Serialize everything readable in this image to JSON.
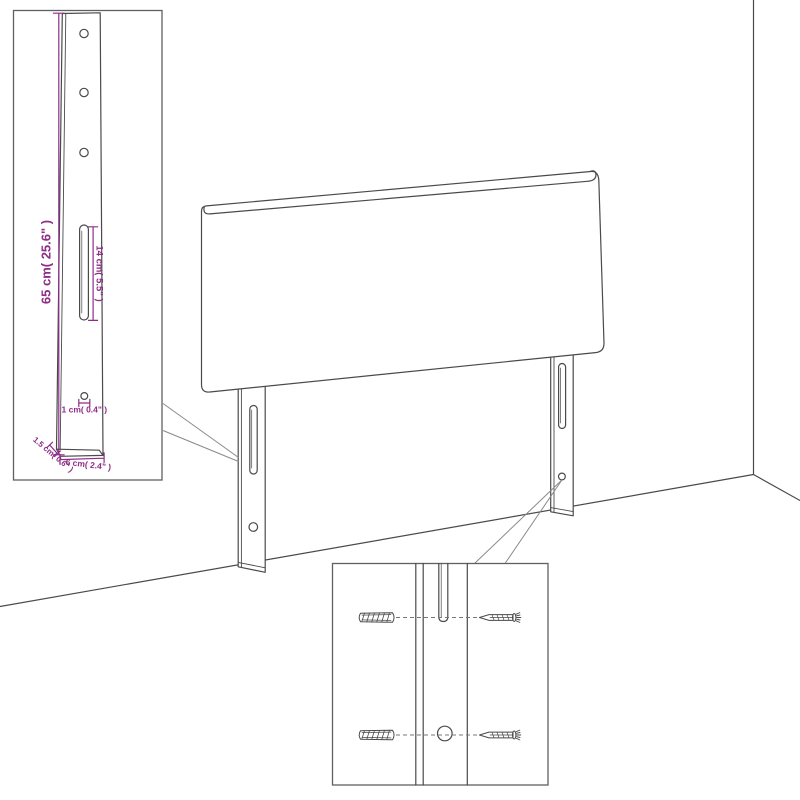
{
  "title": "headboard-assembly-diagram",
  "colors": {
    "background": "#ffffff",
    "line": "#4a4a4a",
    "dimension": "#8E2C88",
    "leader": "#8a8a8a"
  },
  "inset_leg_detail": {
    "height_label": "65 cm( 25.6\" )",
    "slot_height_label": "14 cm( 5.5\" )",
    "hole_diameter_label": "1 cm( 0.4\" )",
    "thickness_label": "1.5 cm( 0.6\" )",
    "width_label": "6 cm( 2.4\" )"
  },
  "hardware_detail": {
    "wall_plug_icon": "wall-plug-icon",
    "screw_icon": "screw-icon"
  }
}
